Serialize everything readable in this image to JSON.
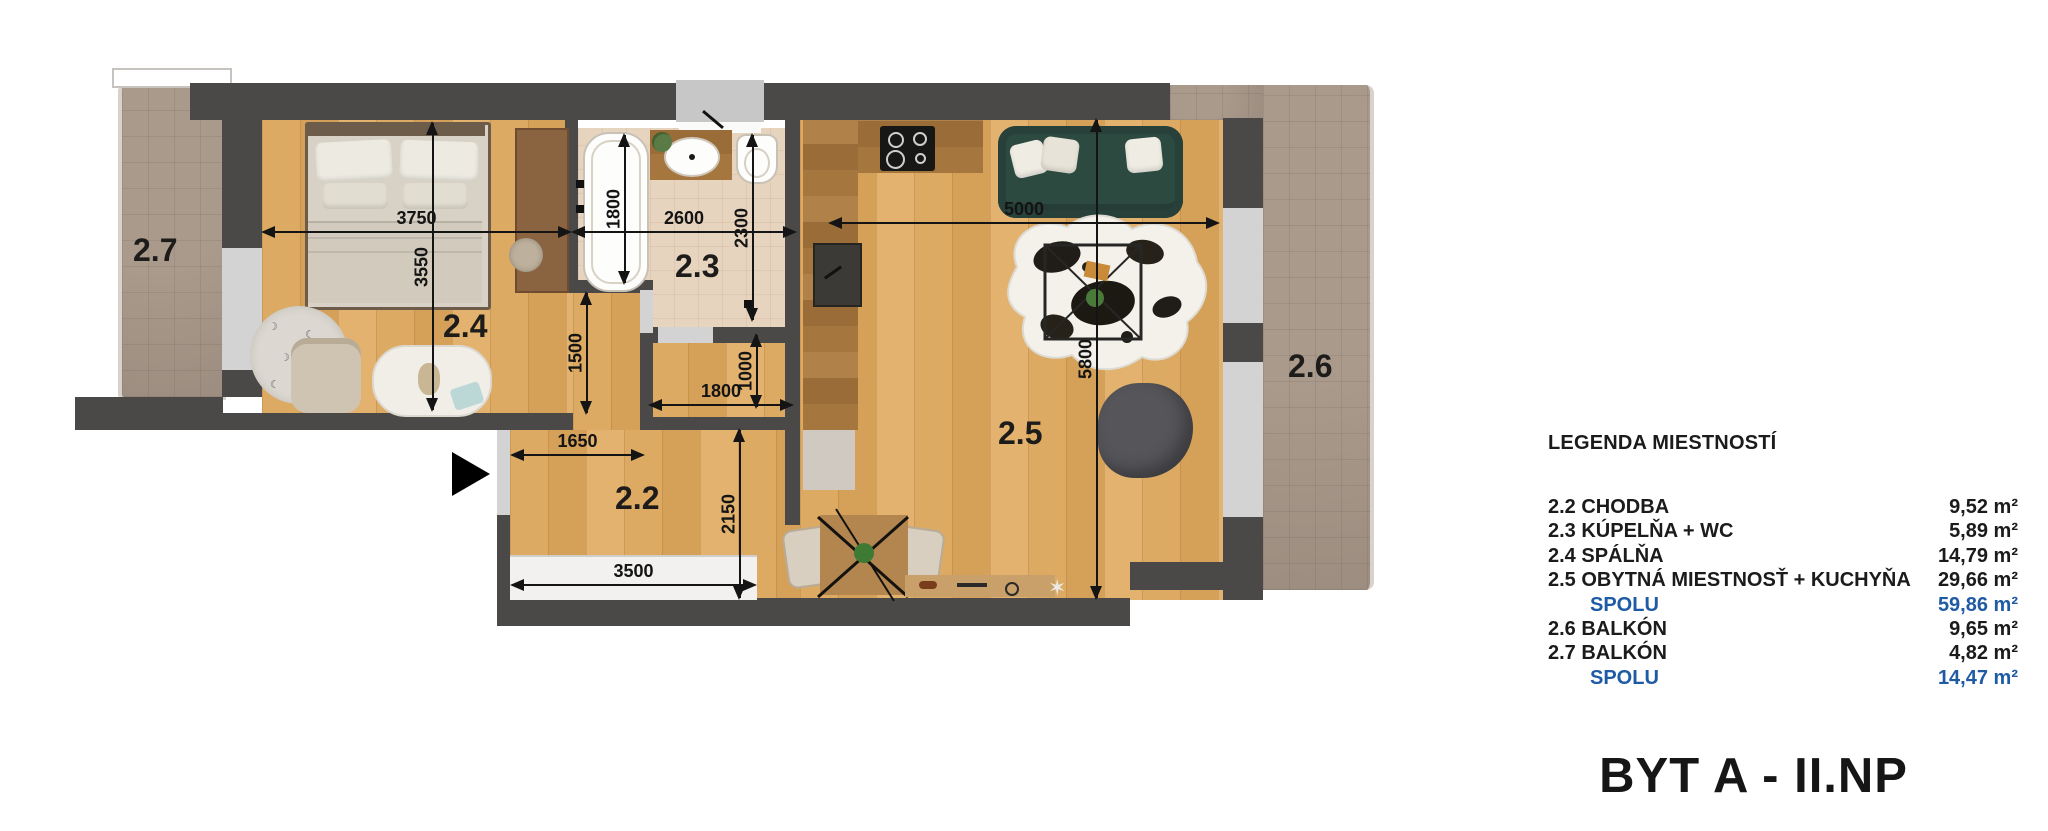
{
  "title": "BYT A - II.NP",
  "plan": {
    "room_labels": {
      "hallway": "2.2",
      "bathroom": "2.3",
      "bedroom": "2.4",
      "living": "2.5",
      "balcony_right": "2.6",
      "balcony_left": "2.7"
    },
    "dimensions_mm": {
      "bedroom_width": "3750",
      "bedroom_height": "3550",
      "bathtub_length": "1800",
      "bathroom_width": "2600",
      "bathroom_height": "2300",
      "living_width": "5000",
      "nook_height": "1500",
      "hall_mid_width": "1800",
      "hall_mid_height": "1000",
      "hall_width": "1650",
      "hall_height": "2150",
      "window_width": "3500",
      "living_height": "5800"
    },
    "icons": {
      "entrance_arrow": "entrance-direction-arrow",
      "star_decal": "✶"
    }
  },
  "legend": {
    "title": "LEGENDA MIESTNOSTÍ",
    "rows": [
      {
        "label": "2.2 CHODBA",
        "value": "9,52 m²",
        "total": false
      },
      {
        "label": "2.3 KÚPELŇA + WC",
        "value": "5,89 m²",
        "total": false
      },
      {
        "label": "2.4 SPÁLŇA",
        "value": "14,79 m²",
        "total": false
      },
      {
        "label": "2.5 OBYTNÁ MIESTNOSŤ + KUCHYŇA",
        "value": "29,66 m²",
        "total": false
      },
      {
        "label": "SPOLU",
        "value": "59,86 m²",
        "total": true
      },
      {
        "label": "2.6  BALKÓN",
        "value": "9,65 m²",
        "total": false
      },
      {
        "label": "2.7  BALKÓN",
        "value": "4,82 m²",
        "total": false
      },
      {
        "label": "SPOLU",
        "value": "14,47 m²",
        "total": true
      }
    ]
  },
  "colors": {
    "wall": "#4a4947",
    "wood_floor": "#dcaa62",
    "wood_dark": "#a6763f",
    "bath_tile": "#e7d4bf",
    "balcony_tile": "#a3948a",
    "opening_gray": "#d3d3d3",
    "sofa_green": "#2d4a41",
    "legend_total_blue": "#1e5ba4"
  }
}
